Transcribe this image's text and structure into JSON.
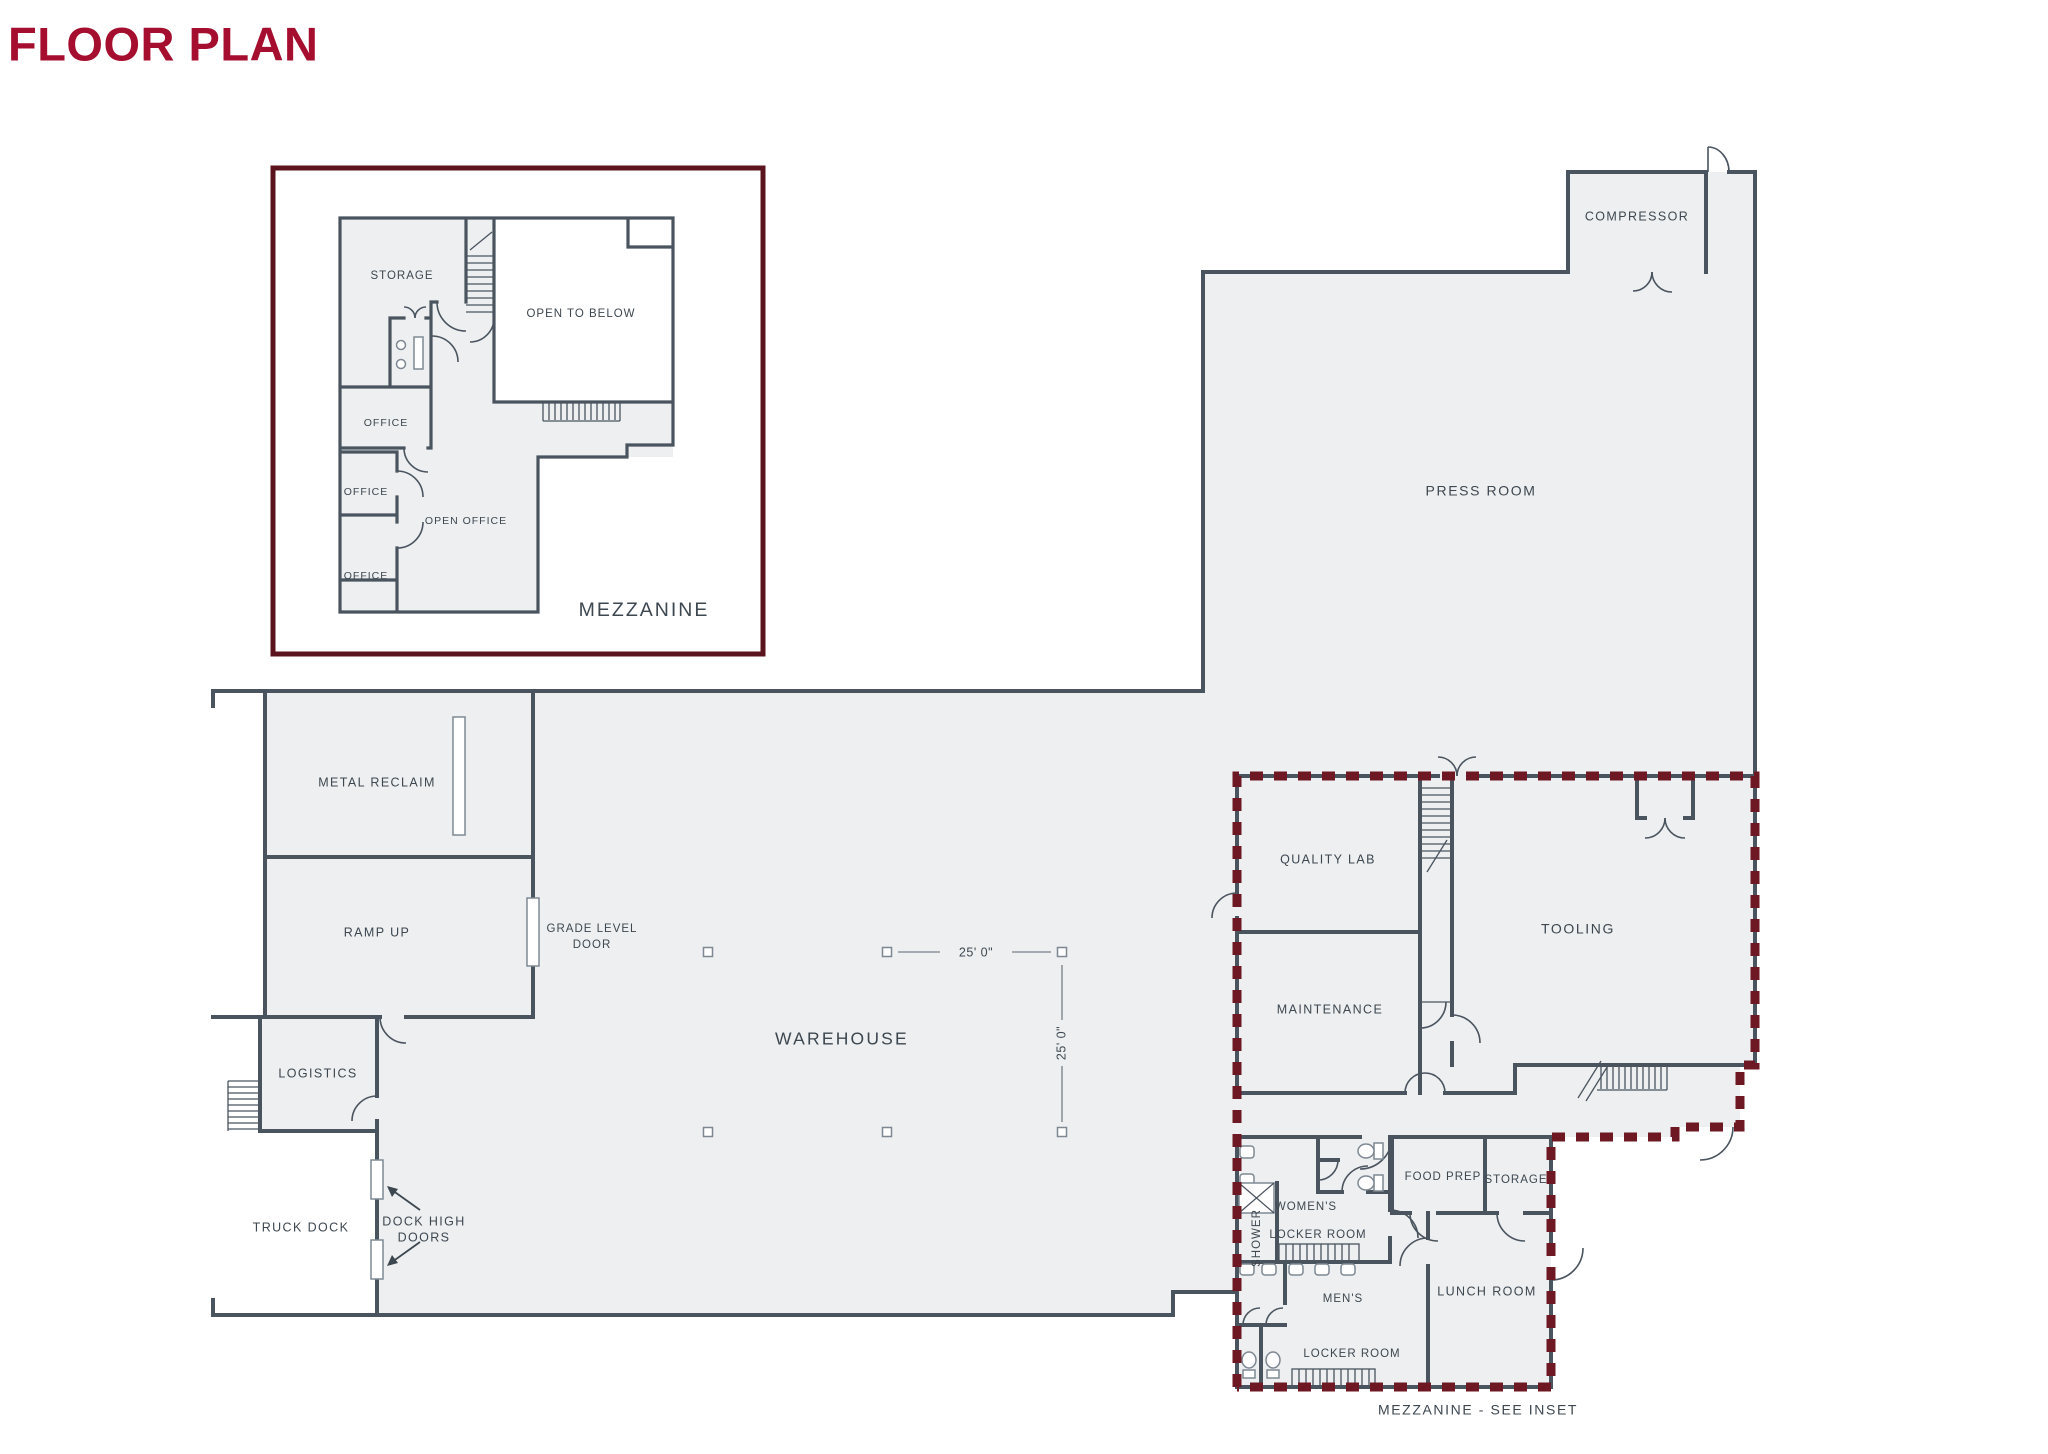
{
  "title": "FLOOR PLAN",
  "colors": {
    "accent_maroon": "#A50E2E",
    "inset_border_maroon": "#5B141E",
    "dash_maroon": "#6D1822",
    "wall": "#4A545F",
    "room_fill": "#EDEFF0",
    "label": "#3D4750"
  },
  "inset": {
    "label": "MEZZANINE",
    "rooms": {
      "storage": "STORAGE",
      "open_to_below": "OPEN TO BELOW",
      "office_a": "OFFICE",
      "office_b": "OFFICE",
      "office_c": "OFFICE",
      "open_office": "OPEN OFFICE"
    }
  },
  "main": {
    "rooms": {
      "compressor": "COMPRESSOR",
      "press_room": "PRESS ROOM",
      "metal_reclaim": "METAL RECLAIM",
      "ramp_up": "RAMP UP",
      "grade_level_door_line1": "GRADE LEVEL",
      "grade_level_door_line2": "DOOR",
      "warehouse": "WAREHOUSE",
      "logistics": "LOGISTICS",
      "truck_dock": "TRUCK DOCK",
      "dock_high_doors_line1": "DOCK HIGH",
      "dock_high_doors_line2": "DOORS",
      "quality_lab": "QUALITY LAB",
      "maintenance": "MAINTENANCE",
      "tooling": "TOOLING",
      "shower": "SHOWER",
      "womens": "WOMEN'S",
      "womens_locker": "LOCKER ROOM",
      "mens": "MEN'S",
      "mens_locker": "LOCKER ROOM",
      "food_prep": "FOOD PREP",
      "storage": "STORAGE",
      "lunch_room": "LUNCH ROOM"
    },
    "dimensions": {
      "horizontal": "25' 0\"",
      "vertical": "25' 0\""
    },
    "note": "MEZZANINE - SEE INSET"
  }
}
